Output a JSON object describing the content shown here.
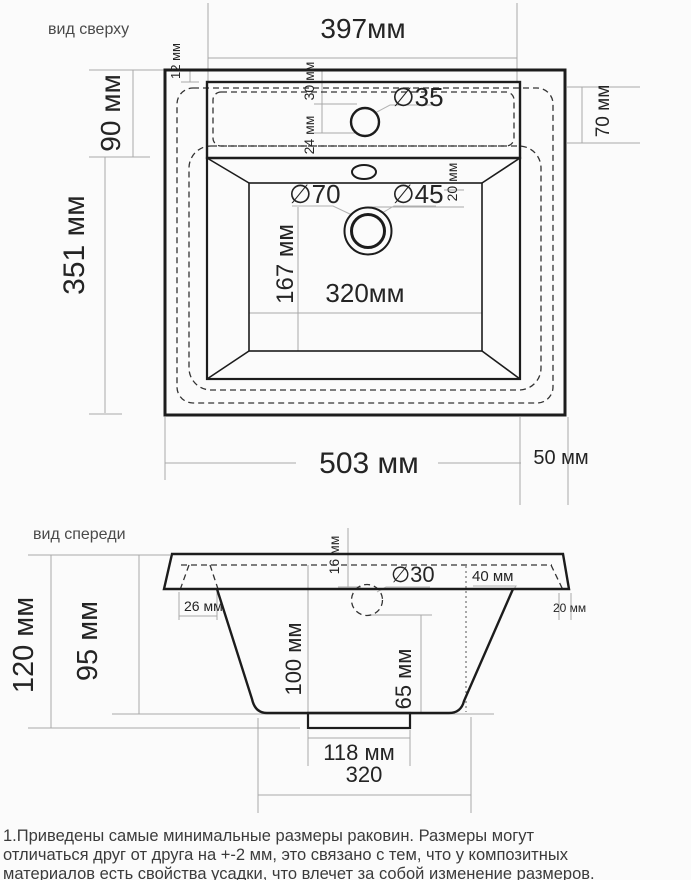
{
  "views": {
    "top": {
      "label": "вид сверху",
      "total_width_top": "397мм",
      "rim_offset": "12 мм",
      "back_deck_depth": "90 мм",
      "hole_from_back": "30 мм",
      "hole_to_deck_edge": "24 мм",
      "faucet_hole": "∅35",
      "deck_depth_right": "70 мм",
      "bowl_length": "351 мм",
      "drain_outer": "∅70",
      "drain_inner": "∅45",
      "drain_offset": "20 мм",
      "drain_to_front": "167 мм",
      "bowl_width": "320мм",
      "total_width": "503 мм",
      "side_margin": "50 мм"
    },
    "front": {
      "label": "вид спереди",
      "total_height": "120 мм",
      "bowl_height": "95 мм",
      "rim_thickness": "16 мм",
      "wall_inset": "26 мм",
      "faucet_hole": "∅30",
      "deck_width": "40 мм",
      "edge_overhang": "20 мм",
      "bowl_depth": "100 мм",
      "drain_depth": "65 мм",
      "flange_width": "118 мм",
      "bottom_width": "320"
    }
  },
  "note": {
    "line1": "1.Приведены самые минимальные размеры раковин. Размеры могут",
    "line2": "отличаться друг от друга на +-2 мм, это связано с тем, что у композитных",
    "line3": "материалов есть свойства усадки, что влечет за собой изменение размеров."
  },
  "colors": {
    "ink": "#1c1c1c",
    "dimension_lines": "#a8a8a8",
    "background": "#fbfbfb"
  }
}
